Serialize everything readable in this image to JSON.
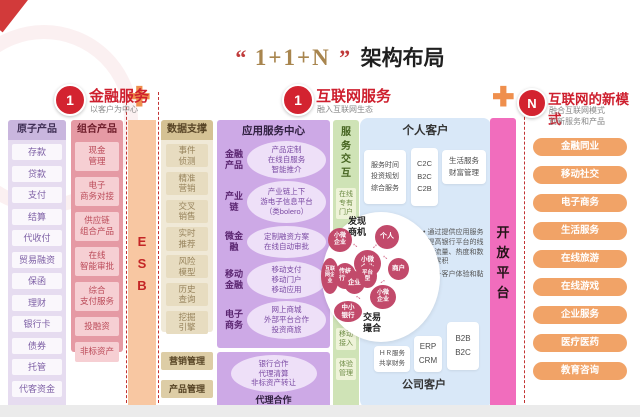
{
  "title": {
    "quote_open": "“",
    "main": "1+1+N",
    "quote_close": "”",
    "suffix": "架构布局"
  },
  "sections": {
    "financial": {
      "badge": "1",
      "title": "金融服务",
      "subtitle": "以客户为中心"
    },
    "internet": {
      "badge": "1",
      "title": "互联网服务",
      "subtitle": "融入互联网生态"
    },
    "new_modes": {
      "badge": "N",
      "title": "互联网的新模式",
      "subtitle": "融合互联网模式\n创新服务和产品"
    }
  },
  "columns": {
    "atomic": {
      "header": "原子产品",
      "items": [
        "存款",
        "贷款",
        "支付",
        "结算",
        "代收付",
        "贸易融资",
        "保函",
        "理财",
        "银行卡",
        "债券",
        "托管",
        "代客资金"
      ]
    },
    "composite": {
      "header": "组合产品",
      "items": [
        "现金\n管理",
        "电子\n商务对接",
        "供应链\n组合产品",
        "在线\n智能审批",
        "综合\n支付服务",
        "投融资",
        "非标资产"
      ]
    },
    "esb": {
      "label": "E\nS\nB"
    },
    "data_support": {
      "header": "数据支撑",
      "items": [
        "事件\n侦测",
        "精准\n营销",
        "交叉\n销售",
        "实时\n推荐",
        "风险\n模型",
        "历史\n查询",
        "挖掘\n引擎"
      ],
      "extra_1": "营销管理",
      "extra_2": "产品管理"
    },
    "app_center": {
      "header": "应用服务中心",
      "rows": [
        {
          "label": "金融\n产品",
          "desc": "产品定制\n在线自服务\n智能推介"
        },
        {
          "label": "产业\n链",
          "desc": "产业链上下\n游电子信息平台\n（类bolero）"
        },
        {
          "label": "微金\n融",
          "desc": "定制融资方案\n在线自动审批"
        },
        {
          "label": "移动\n金融",
          "desc": "移动支付\n移动门户\n移动应用"
        },
        {
          "label": "电子\n商务",
          "desc": "网上商城\n外部平台合作\n投资商旅"
        }
      ],
      "agency_desc": "银行合作\n代理清算\n非标资产转让",
      "agency_label": "代理合作"
    },
    "interaction": {
      "header": "服\n务\n交\n互",
      "item_1": "在线\n专有\n门户",
      "item_2": "移动\n接入",
      "item_3": "体验\n管理"
    }
  },
  "customer_panel": {
    "personal_header": "个人客户",
    "corporate_header": "公司客户",
    "service_box": "服务时间\n投资规划\n综合服务",
    "c2c_box": "C2C\nB2C\nC2B",
    "life_box": "生活服务\n财富管理",
    "hr_box": "ＨＲ服务\n共享财务",
    "erp_box": "ERP\nCRM",
    "b2b_box": "B2B\nB2C",
    "bullet_1": "通过提供应用服务提高银行平台的线上流量、热度和数据累积",
    "bullet_2": "提升客户体验和黏性",
    "bubble_map": {
      "discover_label": "发现\n商机",
      "match_label": "交易\n撮合",
      "bubbles": [
        "小微\n企业",
        "个人",
        "小微\n企业",
        "互联\n网企\n业",
        "传统\n行业",
        "企业",
        "平台\n型",
        "商户",
        "小微\n企业",
        "中小\n银行"
      ]
    }
  },
  "open_platform": {
    "label": "开\n放\n平\n台"
  },
  "new_modes": {
    "items": [
      "金融同业",
      "移动社交",
      "电子商务",
      "生活服务",
      "在线旅游",
      "在线游戏",
      "企业服务",
      "医疗医药",
      "教育咨询"
    ]
  },
  "colors": {
    "accent_red": "#ce1f2e",
    "gold": "#a8854e",
    "orange_plus": "#ef8f4d",
    "open_platform_pink": "#f16dbd",
    "mode_button_orange": "#f1a367",
    "bubble_rose": "#c24a6b"
  }
}
